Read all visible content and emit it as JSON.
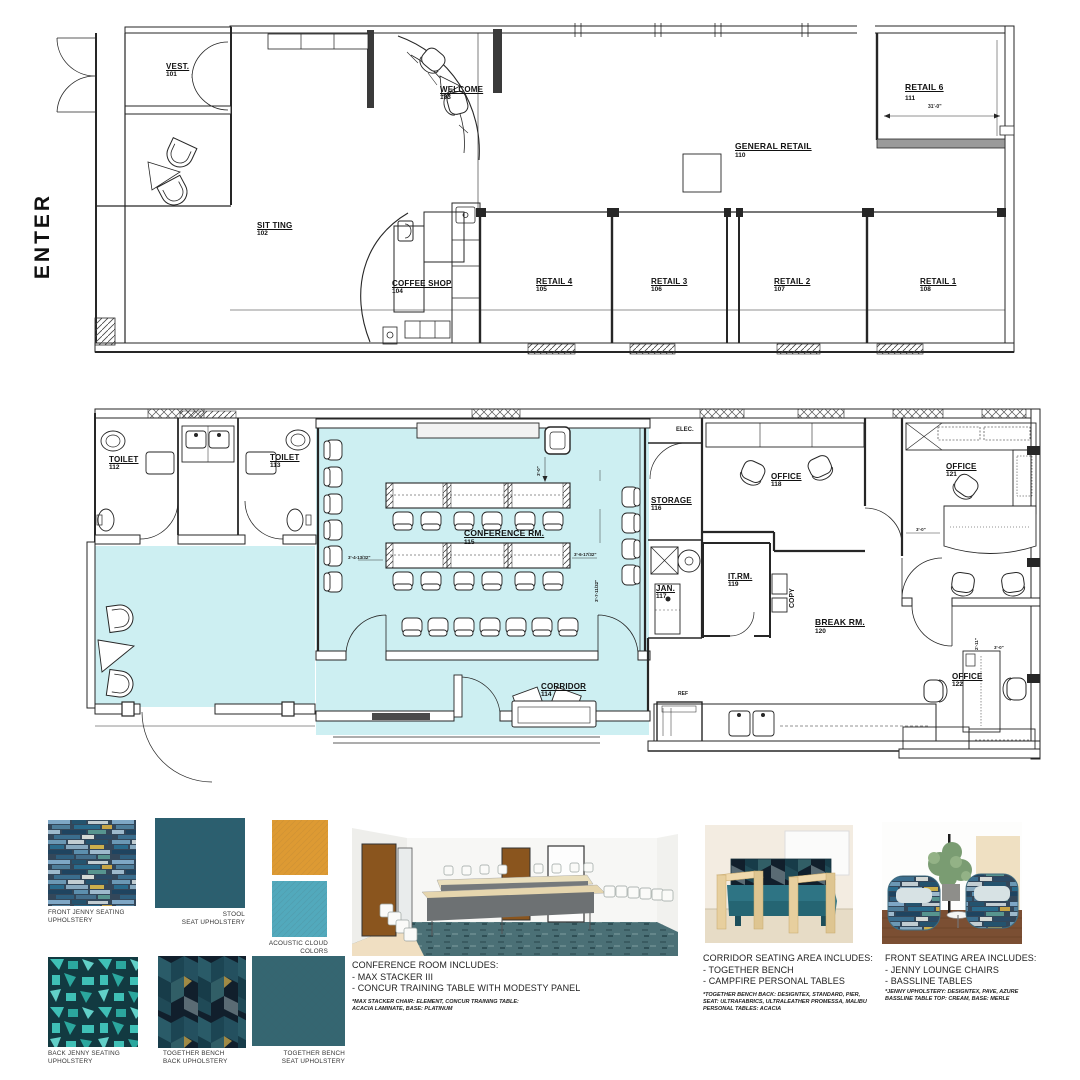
{
  "enter_label": "ENTER",
  "plan_top": {
    "rooms": [
      {
        "name": "VEST.",
        "number": "101"
      },
      {
        "name": "SIT TING",
        "number": "102"
      },
      {
        "name": "WELCOME",
        "number": "103"
      },
      {
        "name": "COFFEE SHOP",
        "number": "104"
      },
      {
        "name": "RETAIL 4",
        "number": "105"
      },
      {
        "name": "RETAIL 3",
        "number": "106"
      },
      {
        "name": "RETAIL 2",
        "number": "107"
      },
      {
        "name": "RETAIL 1",
        "number": "108"
      },
      {
        "name": "GENERAL RETAIL",
        "number": "110"
      },
      {
        "name": "RETAIL 6",
        "number": "111"
      }
    ],
    "dimensions": {
      "retail6_width": "31'-0\""
    }
  },
  "plan_mid": {
    "highlight_color": "#cdeff2",
    "rooms": [
      {
        "name": "TOILET",
        "number": "112"
      },
      {
        "name": "TOILET",
        "number": "113"
      },
      {
        "name": "CORRIDOR",
        "number": "114"
      },
      {
        "name": "CONFERENCE RM.",
        "number": "115"
      },
      {
        "name": "STORAGE",
        "number": "116"
      },
      {
        "name": "JAN.",
        "number": "117"
      },
      {
        "name": "OFFICE",
        "number": "118"
      },
      {
        "name": "IT.RM.",
        "number": "119"
      },
      {
        "name": "BREAK RM.",
        "number": "120"
      },
      {
        "name": "OFFICE",
        "number": "121"
      },
      {
        "name": "OFFICE",
        "number": "122"
      }
    ],
    "labels": {
      "elec": "ELEC.",
      "copy": "COPY",
      "ref": "REF"
    },
    "dimensions": {
      "conf_left": "3'-4-13/32\"",
      "conf_right": "3'-6-17/32\"",
      "conf_right_v": "3'-7-11/32\"",
      "conf_top": "3'-0\"",
      "office121": "3'-0\"",
      "office122_v": "2'-11\"",
      "office122_h": "3'-0\""
    }
  },
  "board": {
    "swatches": [
      {
        "label_line1": "FRONT JENNY SEATING",
        "label_line2": "UPHOLSTERY"
      },
      {
        "label_line1": "STOOL",
        "label_line2": "SEAT UPHOLSTERY"
      },
      {
        "label_line1": "ACOUSTIC CLOUD",
        "label_line2": "COLORS"
      },
      {
        "label_line1": "BACK JENNY SEATING",
        "label_line2": "UPHOLSTERY"
      },
      {
        "label_line1": "TOGETHER BENCH",
        "label_line2": "BACK UPHOLSTERY"
      },
      {
        "label_line1": "TOGETHER BENCH",
        "label_line2": "SEAT UPHOLSTERY"
      }
    ],
    "colors": {
      "acoustic_orange": "#dd9a33",
      "acoustic_teal": "#52a9bc",
      "stool_teal": "#2b5f6f",
      "bench_seat_teal": "#356671"
    },
    "sections": [
      {
        "heading": "CONFERENCE ROOM INCLUDES:",
        "bullets": [
          "- MAX STACKER III",
          "- CONCUR TRAINING TABLE WITH MODESTY PANEL"
        ],
        "fine_print": [
          "*MAX STACKER CHAIR: ELEMENT, CONCUR TRAINING TABLE:",
          "ACACIA LAMINATE, BASE: PLATINUM"
        ]
      },
      {
        "heading": "CORRIDOR SEATING AREA INCLUDES:",
        "bullets": [
          "- TOGETHER BENCH",
          "- CAMPFIRE PERSONAL TABLES"
        ],
        "fine_print": [
          "*TOGETHER BENCH BACK: DESIGNTEX, STANDARD, PIER,",
          "SEAT: ULTRAFABRICS, ULTRALEATHER PROMESSA, MALIBU",
          "PERSONAL TABLES: ACACIA"
        ]
      },
      {
        "heading": "FRONT SEATING AREA INCLUDES:",
        "bullets": [
          "- JENNY LOUNGE CHAIRS",
          "- BASSLINE TABLES"
        ],
        "fine_print": [
          "*JENNY UPHOLSTERY: DESIGNTEX, PAVE, AZURE",
          "BASSLINE TABLE TOP: CREAM, BASE: MERLE"
        ]
      }
    ]
  }
}
